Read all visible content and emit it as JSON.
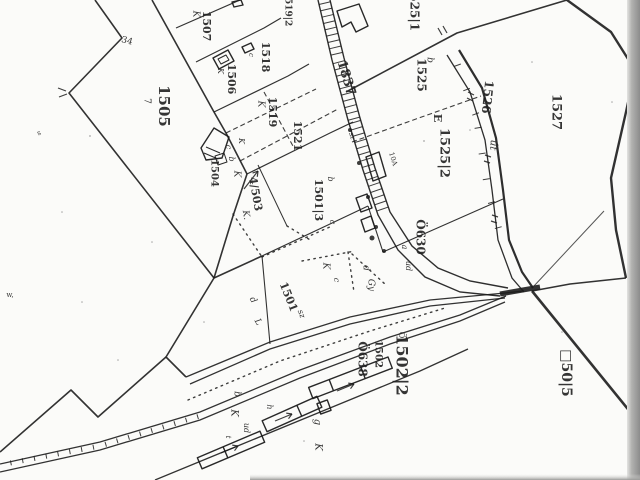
{
  "page": {
    "title": "scanned cadastral parcel map"
  },
  "colors": {
    "ink": "#1c1c1c",
    "paper": "#fbfbf9",
    "scan_edge_dark": "#8c8c8c",
    "scan_edge_light": "#d8d8d8"
  },
  "labels": [
    {
      "t": "1505",
      "x": 163,
      "y": 106,
      "r": 90,
      "s": 15,
      "b": 1
    },
    {
      "t": "1507",
      "x": 206,
      "y": 26,
      "r": 90,
      "s": 11,
      "b": 1
    },
    {
      "t": "K",
      "x": 196,
      "y": 14,
      "r": 90,
      "s": 9,
      "i": 1
    },
    {
      "t": "1506",
      "x": 231,
      "y": 79,
      "r": 90,
      "s": 11,
      "b": 1
    },
    {
      "t": "K",
      "x": 220,
      "y": 71,
      "r": 90,
      "s": 8,
      "i": 1
    },
    {
      "t": "1518",
      "x": 265,
      "y": 57,
      "r": 90,
      "s": 11,
      "b": 1
    },
    {
      "t": "c",
      "x": 251,
      "y": 55,
      "r": 90,
      "s": 7,
      "i": 1
    },
    {
      "t": "1519",
      "x": 272,
      "y": 112,
      "r": 90,
      "s": 11,
      "b": 1
    },
    {
      "t": "K",
      "x": 261,
      "y": 104,
      "r": 90,
      "s": 9,
      "i": 1
    },
    {
      "t": "1519|2",
      "x": 288,
      "y": 9,
      "r": 90,
      "s": 9,
      "b": 1
    },
    {
      "t": "1521",
      "x": 297,
      "y": 136,
      "r": 90,
      "s": 11,
      "b": 1
    },
    {
      "t": "1525|1",
      "x": 414,
      "y": 8,
      "r": 90,
      "s": 12,
      "b": 1
    },
    {
      "t": "1525",
      "x": 421,
      "y": 75,
      "r": 90,
      "s": 12,
      "b": 1
    },
    {
      "t": "b",
      "x": 430,
      "y": 60,
      "r": 90,
      "s": 9,
      "i": 1
    },
    {
      "t": "E",
      "x": 437,
      "y": 118,
      "r": 90,
      "s": 11,
      "b": 1
    },
    {
      "t": "1525|2",
      "x": 444,
      "y": 153,
      "r": 90,
      "s": 13,
      "b": 1
    },
    {
      "t": "1526",
      "x": 487,
      "y": 97,
      "r": 96,
      "s": 12,
      "b": 1
    },
    {
      "t": "út",
      "x": 493,
      "y": 145,
      "r": 96,
      "s": 10,
      "i": 1
    },
    {
      "t": "1527",
      "x": 556,
      "y": 112,
      "r": 90,
      "s": 13,
      "b": 1
    },
    {
      "t": "1837",
      "x": 346,
      "y": 78,
      "r": 73,
      "s": 13,
      "b": 1
    },
    {
      "t": "1504",
      "x": 214,
      "y": 173,
      "r": 90,
      "s": 10,
      "b": 1
    },
    {
      "t": "b",
      "x": 231,
      "y": 159,
      "r": 90,
      "s": 8,
      "i": 1
    },
    {
      "t": "K",
      "x": 237,
      "y": 174,
      "r": 90,
      "s": 9,
      "i": 1
    },
    {
      "t": "c",
      "x": 228,
      "y": 147,
      "r": 90,
      "s": 8,
      "i": 1
    },
    {
      "t": "K",
      "x": 241,
      "y": 141,
      "r": 90,
      "s": 8,
      "i": 1
    },
    {
      "t": "4/503",
      "x": 255,
      "y": 194,
      "r": 80,
      "s": 11,
      "b": 1
    },
    {
      "t": "K.",
      "x": 246,
      "y": 215,
      "r": 80,
      "s": 9,
      "i": 1
    },
    {
      "t": "1501|3",
      "x": 318,
      "y": 200,
      "r": 90,
      "s": 11,
      "b": 1
    },
    {
      "t": "b",
      "x": 330,
      "y": 179,
      "r": 90,
      "s": 8,
      "i": 1
    },
    {
      "t": "c",
      "x": 332,
      "y": 222,
      "r": 90,
      "s": 8,
      "i": 1
    },
    {
      "t": "1501",
      "x": 288,
      "y": 297,
      "r": 68,
      "s": 11,
      "b": 1
    },
    {
      "t": "sz",
      "x": 301,
      "y": 314,
      "r": 68,
      "s": 8,
      "i": 1
    },
    {
      "t": "K",
      "x": 326,
      "y": 266,
      "r": 90,
      "s": 9,
      "i": 1
    },
    {
      "t": "c",
      "x": 336,
      "y": 280,
      "r": 90,
      "s": 8,
      "i": 1
    },
    {
      "t": "d",
      "x": 366,
      "y": 268,
      "r": 90,
      "s": 9,
      "i": 1
    },
    {
      "t": "Gy",
      "x": 371,
      "y": 285,
      "r": 90,
      "s": 9,
      "i": 1
    },
    {
      "t": "a",
      "x": 404,
      "y": 247,
      "r": 90,
      "s": 8,
      "i": 1
    },
    {
      "t": "ud",
      "x": 408,
      "y": 266,
      "r": 90,
      "s": 8,
      "i": 1
    },
    {
      "t": "Ö630",
      "x": 420,
      "y": 237,
      "r": 90,
      "s": 12,
      "b": 1
    },
    {
      "t": "Ö",
      "x": 401,
      "y": 335,
      "r": 90,
      "s": 8
    },
    {
      "t": "1502|2",
      "x": 401,
      "y": 365,
      "r": 90,
      "s": 16,
      "b": 1
    },
    {
      "t": "1502",
      "x": 378,
      "y": 354,
      "r": 90,
      "s": 10,
      "b": 1
    },
    {
      "t": "Ö638",
      "x": 362,
      "y": 359,
      "r": 90,
      "s": 12,
      "b": 1
    },
    {
      "t": "□50|5",
      "x": 566,
      "y": 373,
      "r": 90,
      "s": 14,
      "b": 1
    },
    {
      "t": "34",
      "x": 127,
      "y": 41,
      "r": 15,
      "s": 9
    },
    {
      "t": "7",
      "x": 147,
      "y": 101,
      "r": 90,
      "s": 9
    },
    {
      "t": "b",
      "x": 237,
      "y": 394,
      "r": 90,
      "s": 9,
      "i": 1
    },
    {
      "t": "K",
      "x": 234,
      "y": 413,
      "r": 90,
      "s": 10,
      "i": 1
    },
    {
      "t": "ud",
      "x": 246,
      "y": 428,
      "r": 90,
      "s": 8,
      "i": 1
    },
    {
      "t": "h",
      "x": 269,
      "y": 407,
      "r": 90,
      "s": 8,
      "i": 1
    },
    {
      "t": "g",
      "x": 317,
      "y": 422,
      "r": 90,
      "s": 10,
      "i": 1
    },
    {
      "t": "K",
      "x": 318,
      "y": 447,
      "r": 90,
      "s": 10,
      "i": 1
    },
    {
      "t": "t",
      "x": 228,
      "y": 437,
      "r": 90,
      "s": 7,
      "i": 1
    },
    {
      "t": "sz",
      "x": 352,
      "y": 136,
      "r": 73,
      "s": 7,
      "i": 1
    },
    {
      "t": "10A",
      "x": 393,
      "y": 159,
      "r": 73,
      "s": 7
    },
    {
      "t": "d",
      "x": 253,
      "y": 300,
      "r": 60,
      "s": 9,
      "i": 1
    },
    {
      "t": "L",
      "x": 258,
      "y": 322,
      "r": 60,
      "s": 9,
      "i": 1
    },
    {
      "t": "w,",
      "x": 10,
      "y": 295,
      "r": 0,
      "s": 7
    },
    {
      "t": "s",
      "x": 39,
      "y": 133,
      "r": -20,
      "s": 7
    }
  ]
}
